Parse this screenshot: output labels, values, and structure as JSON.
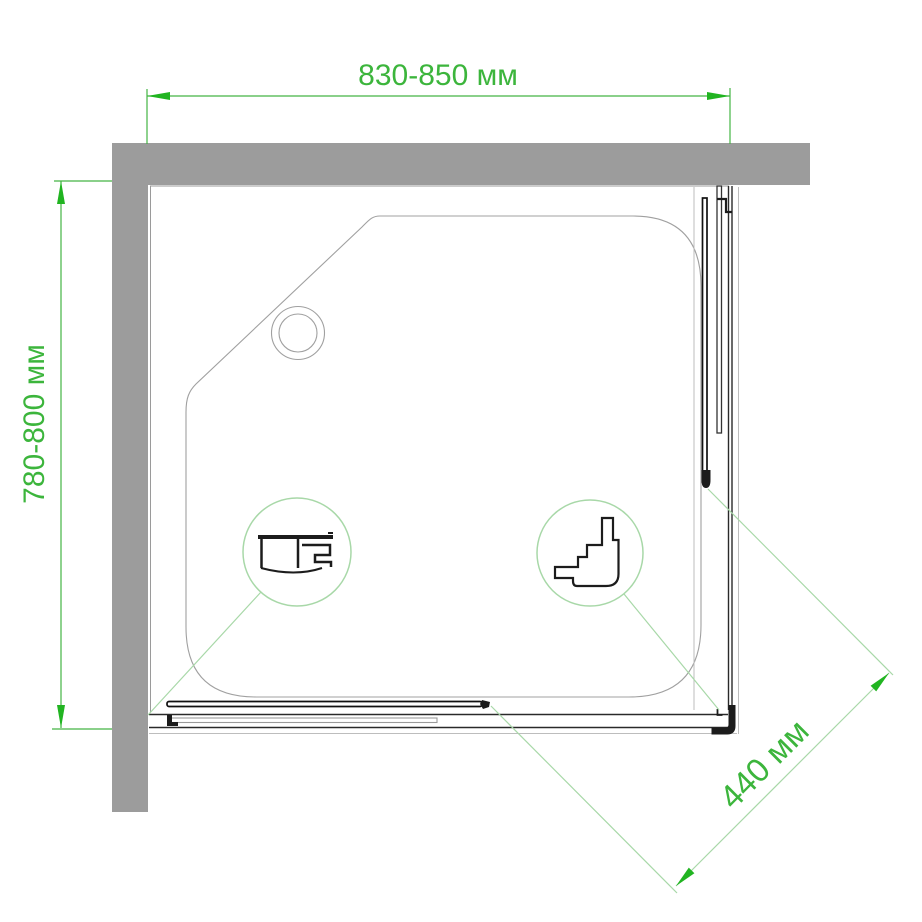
{
  "labels": {
    "width": "830-850 мм",
    "depth": "780-800 мм",
    "entry": "440 мм"
  },
  "colors": {
    "dimension_text": "#3cb53c",
    "dimension_line": "#44b544",
    "leader_light_green": "#a8d8a8",
    "arrow_green": "#21b421",
    "wall_gray": "#9c9c9c",
    "drawing_dark": "#1c1c1c",
    "tray_outline": "#a0a0a0",
    "background": "#ffffff"
  }
}
